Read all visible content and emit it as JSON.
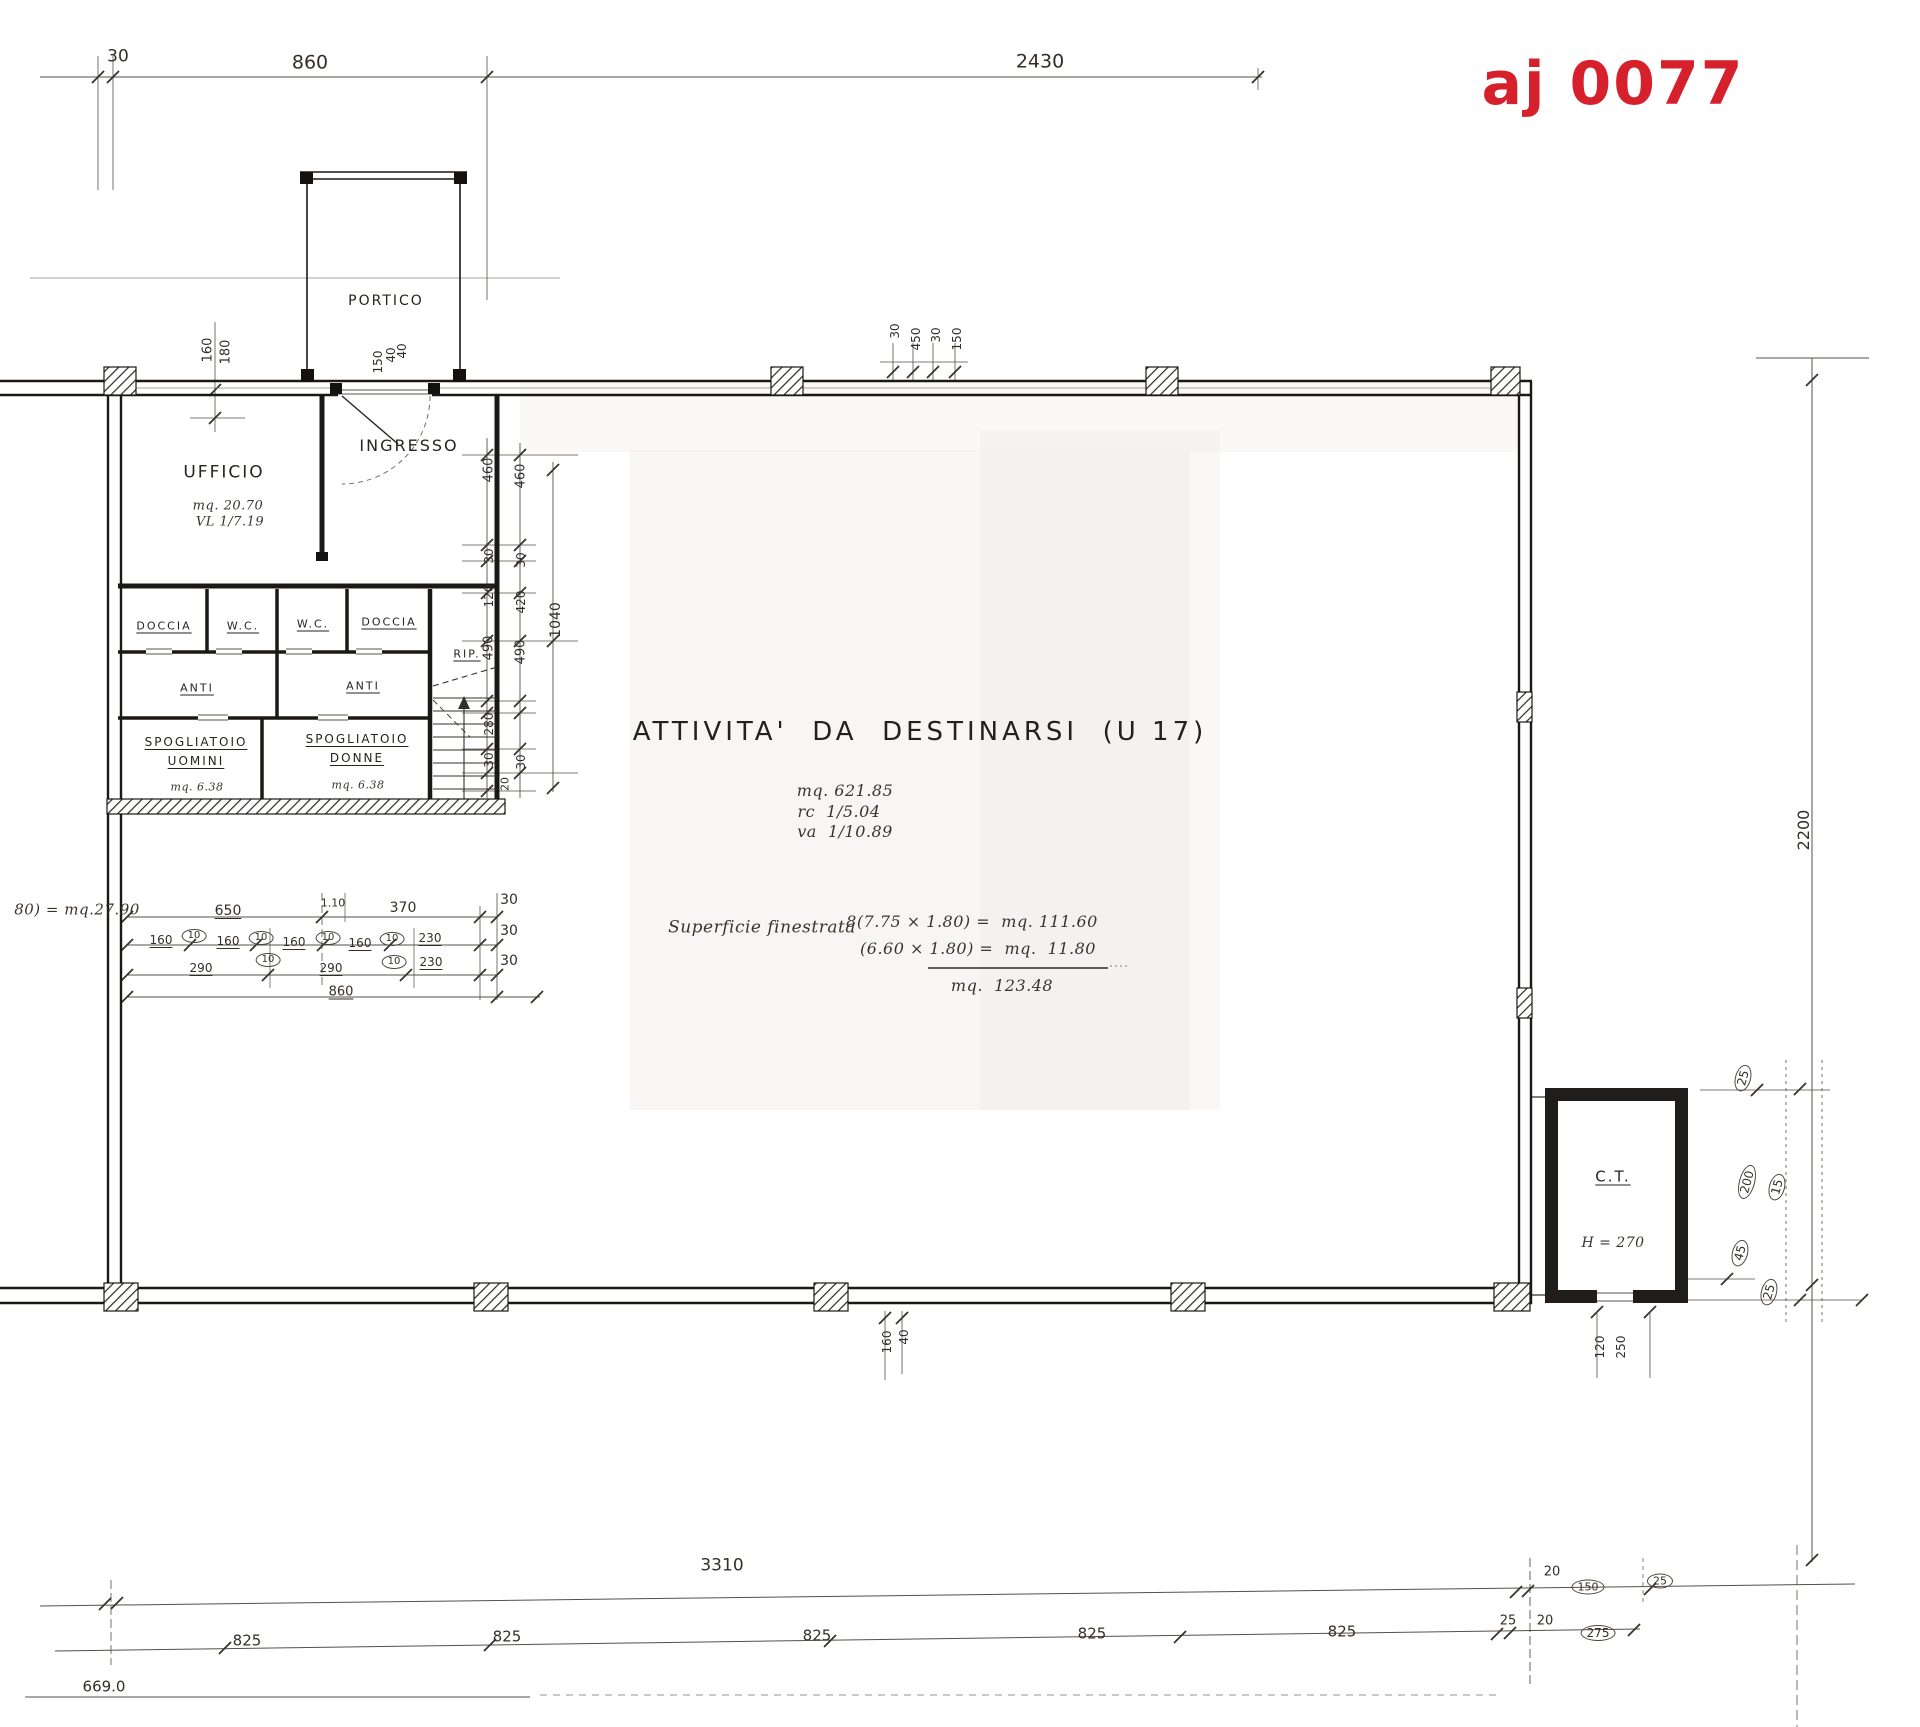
{
  "stamp": {
    "text": "aj 0077",
    "color": "#d6202b"
  },
  "labels": [
    {
      "n": "dim-top-30",
      "t": "30",
      "x": 118,
      "y": 57,
      "fs": 17
    },
    {
      "n": "dim-top-860",
      "t": "860",
      "x": 310,
      "y": 63,
      "fs": 19
    },
    {
      "n": "dim-top-2430",
      "t": "2430",
      "x": 1040,
      "y": 62,
      "fs": 19
    },
    {
      "n": "room-portico",
      "t": "PORTICO",
      "x": 386,
      "y": 301,
      "fs": 14,
      "cls": "room"
    },
    {
      "n": "dim-160",
      "t": "160",
      "x": 208,
      "y": 350,
      "r": -90,
      "fs": 13
    },
    {
      "n": "dim-180",
      "t": "180",
      "x": 226,
      "y": 352,
      "r": -90,
      "fs": 13
    },
    {
      "n": "dim-150",
      "t": "150",
      "x": 378,
      "y": 362,
      "r": -90,
      "fs": 12
    },
    {
      "n": "dim-40",
      "t": "40",
      "x": 391,
      "y": 355,
      "r": -90,
      "fs": 12
    },
    {
      "n": "dim-40",
      "t": "40",
      "x": 402,
      "y": 351,
      "r": -90,
      "fs": 12
    },
    {
      "n": "dim-30",
      "t": "30",
      "x": 895,
      "y": 331,
      "r": -90,
      "fs": 12
    },
    {
      "n": "dim-450",
      "t": "450",
      "x": 916,
      "y": 339,
      "r": -90,
      "fs": 12
    },
    {
      "n": "dim-30",
      "t": "30",
      "x": 936,
      "y": 335,
      "r": -90,
      "fs": 12
    },
    {
      "n": "dim-150",
      "t": "150",
      "x": 957,
      "y": 339,
      "r": -90,
      "fs": 12
    },
    {
      "n": "room-ingresso",
      "t": "INGRESSO",
      "x": 409,
      "y": 446,
      "fs": 16,
      "cls": "room"
    },
    {
      "n": "room-ufficio",
      "t": "UFFICIO",
      "x": 224,
      "y": 473,
      "fs": 17,
      "cls": "room"
    },
    {
      "n": "ufficio-area",
      "t": "mq. 20.70",
      "x": 228,
      "y": 506,
      "fs": 13,
      "cls": "script"
    },
    {
      "n": "ufficio-ratio",
      "t": "VL 1/7.19",
      "x": 230,
      "y": 522,
      "fs": 13,
      "cls": "script"
    },
    {
      "n": "room-doccia",
      "t": "DOCCIA",
      "x": 164,
      "y": 626,
      "fs": 11,
      "cls": "room und"
    },
    {
      "n": "room-wc",
      "t": "W.C.",
      "x": 243,
      "y": 626,
      "fs": 11,
      "cls": "room und"
    },
    {
      "n": "room-wc",
      "t": "W.C.",
      "x": 313,
      "y": 624,
      "fs": 11,
      "cls": "room und"
    },
    {
      "n": "room-doccia",
      "t": "DOCCIA",
      "x": 389,
      "y": 622,
      "fs": 11,
      "cls": "room und"
    },
    {
      "n": "room-rip",
      "t": "RIP.",
      "x": 467,
      "y": 654,
      "fs": 11,
      "cls": "room und"
    },
    {
      "n": "room-anti",
      "t": "ANTI",
      "x": 197,
      "y": 688,
      "fs": 11,
      "cls": "room und"
    },
    {
      "n": "room-anti",
      "t": "ANTI",
      "x": 363,
      "y": 686,
      "fs": 11,
      "cls": "room und"
    },
    {
      "n": "room-spogliatoio-uomini",
      "t": "SPOGLIATOIO",
      "x": 196,
      "y": 742,
      "fs": 12,
      "cls": "room und"
    },
    {
      "n": "room-spogliatoio-uomini",
      "t": "UOMINI",
      "x": 196,
      "y": 761,
      "fs": 12,
      "cls": "room und"
    },
    {
      "n": "spogliatoio-uomini-area",
      "t": "mq. 6.38",
      "x": 197,
      "y": 787,
      "fs": 11,
      "cls": "script"
    },
    {
      "n": "room-spogliatoio-donne",
      "t": "SPOGLIATOIO",
      "x": 357,
      "y": 739,
      "fs": 12,
      "cls": "room und"
    },
    {
      "n": "room-spogliatoio-donne",
      "t": "DONNE",
      "x": 357,
      "y": 758,
      "fs": 12,
      "cls": "room und"
    },
    {
      "n": "spogliatoio-donne-area",
      "t": "mq. 6.38",
      "x": 358,
      "y": 785,
      "fs": 11,
      "cls": "script"
    },
    {
      "n": "dim-460",
      "t": "460",
      "x": 489,
      "y": 470,
      "r": -90,
      "fs": 13
    },
    {
      "n": "dim-460",
      "t": "460",
      "x": 521,
      "y": 476,
      "r": -90,
      "fs": 13
    },
    {
      "n": "dim-30",
      "t": "30",
      "x": 489,
      "y": 556,
      "r": -90,
      "fs": 12
    },
    {
      "n": "dim-30",
      "t": "30",
      "x": 521,
      "y": 560,
      "r": -90,
      "fs": 12
    },
    {
      "n": "dim-120",
      "t": "120",
      "x": 489,
      "y": 596,
      "r": -90,
      "fs": 12
    },
    {
      "n": "dim-420",
      "t": "420",
      "x": 521,
      "y": 602,
      "r": -90,
      "fs": 12
    },
    {
      "n": "dim-490",
      "t": "490",
      "x": 489,
      "y": 648,
      "r": -90,
      "fs": 13
    },
    {
      "n": "dim-490",
      "t": "490",
      "x": 521,
      "y": 652,
      "r": -90,
      "fs": 13
    },
    {
      "n": "dim-1040",
      "t": "1040",
      "x": 556,
      "y": 620,
      "r": -90,
      "fs": 14
    },
    {
      "n": "dim-280",
      "t": "280",
      "x": 489,
      "y": 724,
      "r": -90,
      "fs": 12
    },
    {
      "n": "dim-30",
      "t": "30",
      "x": 489,
      "y": 760,
      "r": -90,
      "fs": 12
    },
    {
      "n": "dim-30",
      "t": "30",
      "x": 521,
      "y": 762,
      "r": -90,
      "fs": 12
    },
    {
      "n": "dim-20",
      "t": "20",
      "x": 505,
      "y": 784,
      "r": -90,
      "fs": 11
    },
    {
      "n": "activity-title",
      "t": "ATTIVITA'  DA  DESTINARSI  (U 17)",
      "x": 920,
      "y": 732,
      "fs": 26,
      "cls": "big"
    },
    {
      "n": "activity-area",
      "t": "mq. 621.85",
      "x": 845,
      "y": 791,
      "fs": 16,
      "cls": "script"
    },
    {
      "n": "activity-rc",
      "t": "rc  1/5.04",
      "x": 839,
      "y": 812,
      "fs": 16,
      "cls": "script"
    },
    {
      "n": "activity-va",
      "t": "va  1/10.89",
      "x": 845,
      "y": 832,
      "fs": 16,
      "cls": "script"
    },
    {
      "n": "window-calc-label",
      "t": "Superficie finestrata",
      "x": 762,
      "y": 928,
      "fs": 17,
      "cls": "script"
    },
    {
      "n": "window-calc-line1",
      "t": "8(7.75 × 1.80) =  mq. 111.60",
      "x": 972,
      "y": 922,
      "fs": 16,
      "cls": "script"
    },
    {
      "n": "window-calc-line2",
      "t": "(6.60 × 1.80) =  mq.  11.80",
      "x": 978,
      "y": 949,
      "fs": 16,
      "cls": "script"
    },
    {
      "n": "window-calc-total",
      "t": "mq.  123.48",
      "x": 1002,
      "y": 986,
      "fs": 16,
      "cls": "script"
    },
    {
      "n": "left-area-note",
      "t": "80) = mq.27.90",
      "x": 77,
      "y": 910,
      "fs": 15,
      "cls": "script"
    },
    {
      "n": "dim-650",
      "t": "650",
      "x": 228,
      "y": 911,
      "fs": 14,
      "cls": "und"
    },
    {
      "n": "dim-110",
      "t": "1.10",
      "x": 333,
      "y": 903,
      "fs": 11
    },
    {
      "n": "dim-370",
      "t": "370",
      "x": 403,
      "y": 908,
      "fs": 14
    },
    {
      "n": "dim-30",
      "t": "30",
      "x": 509,
      "y": 900,
      "fs": 14
    },
    {
      "n": "dim-160",
      "t": "160",
      "x": 161,
      "y": 940,
      "fs": 12,
      "cls": "und"
    },
    {
      "n": "dim-10",
      "t": "10",
      "x": 194,
      "y": 936,
      "fs": 10,
      "cls": "circ"
    },
    {
      "n": "dim-160",
      "t": "160",
      "x": 228,
      "y": 941,
      "fs": 12,
      "cls": "und"
    },
    {
      "n": "dim-10",
      "t": "10",
      "x": 261,
      "y": 938,
      "fs": 10,
      "cls": "circ"
    },
    {
      "n": "dim-160",
      "t": "160",
      "x": 294,
      "y": 942,
      "fs": 12,
      "cls": "und"
    },
    {
      "n": "dim-10",
      "t": "10",
      "x": 328,
      "y": 938,
      "fs": 10,
      "cls": "circ"
    },
    {
      "n": "dim-160",
      "t": "160",
      "x": 360,
      "y": 943,
      "fs": 12,
      "cls": "und"
    },
    {
      "n": "dim-10",
      "t": "10",
      "x": 392,
      "y": 939,
      "fs": 10,
      "cls": "circ"
    },
    {
      "n": "dim-230",
      "t": "230",
      "x": 430,
      "y": 938,
      "fs": 12,
      "cls": "und"
    },
    {
      "n": "dim-30",
      "t": "30",
      "x": 509,
      "y": 931,
      "fs": 14
    },
    {
      "n": "dim-290",
      "t": "290",
      "x": 201,
      "y": 968,
      "fs": 12,
      "cls": "und"
    },
    {
      "n": "dim-10",
      "t": "10",
      "x": 268,
      "y": 960,
      "fs": 10,
      "cls": "circ"
    },
    {
      "n": "dim-290",
      "t": "290",
      "x": 331,
      "y": 968,
      "fs": 12,
      "cls": "und"
    },
    {
      "n": "dim-10",
      "t": "10",
      "x": 394,
      "y": 962,
      "fs": 10,
      "cls": "circ"
    },
    {
      "n": "dim-230",
      "t": "230",
      "x": 431,
      "y": 962,
      "fs": 12,
      "cls": "und"
    },
    {
      "n": "dim-30",
      "t": "30",
      "x": 509,
      "y": 961,
      "fs": 14
    },
    {
      "n": "dim-860",
      "t": "860",
      "x": 341,
      "y": 992,
      "fs": 13,
      "cls": "und"
    },
    {
      "n": "dim-right-2200",
      "t": "2200",
      "x": 1804,
      "y": 830,
      "r": -90,
      "fs": 16
    },
    {
      "n": "room-ct",
      "t": "C.T.",
      "x": 1613,
      "y": 1177,
      "fs": 15,
      "cls": "room und"
    },
    {
      "n": "ct-height",
      "t": "H = 270",
      "x": 1613,
      "y": 1243,
      "fs": 14,
      "cls": "script"
    },
    {
      "n": "dim-120",
      "t": "120",
      "x": 1600,
      "y": 1347,
      "r": -90,
      "fs": 12
    },
    {
      "n": "dim-250",
      "t": "250",
      "x": 1621,
      "y": 1347,
      "r": -90,
      "fs": 12
    },
    {
      "n": "mark-25",
      "t": "25",
      "x": 1743,
      "y": 1078,
      "r": -75,
      "fs": 12,
      "cls": "circ"
    },
    {
      "n": "mark-200",
      "t": "200",
      "x": 1747,
      "y": 1182,
      "r": -75,
      "fs": 12,
      "cls": "circ"
    },
    {
      "n": "mark-15",
      "t": "15",
      "x": 1777,
      "y": 1187,
      "r": -75,
      "fs": 12,
      "cls": "circ"
    },
    {
      "n": "mark-45",
      "t": "45",
      "x": 1740,
      "y": 1253,
      "r": -75,
      "fs": 12,
      "cls": "circ"
    },
    {
      "n": "mark-25",
      "t": "25",
      "x": 1769,
      "y": 1292,
      "r": -75,
      "fs": 12,
      "cls": "circ"
    },
    {
      "n": "dim-160",
      "t": "160",
      "x": 887,
      "y": 1342,
      "r": -90,
      "fs": 12
    },
    {
      "n": "dim-40",
      "t": "40",
      "x": 904,
      "y": 1337,
      "r": -90,
      "fs": 12
    },
    {
      "n": "dim-bottom-3310",
      "t": "3310",
      "x": 722,
      "y": 1566,
      "fs": 17
    },
    {
      "n": "dim-20",
      "t": "20",
      "x": 1552,
      "y": 1572,
      "fs": 13
    },
    {
      "n": "mark-150",
      "t": "150",
      "x": 1588,
      "y": 1587,
      "fs": 11,
      "cls": "circ"
    },
    {
      "n": "mark-25",
      "t": "25",
      "x": 1660,
      "y": 1581,
      "fs": 11,
      "cls": "circ"
    },
    {
      "n": "dim-825",
      "t": "825",
      "x": 247,
      "y": 1641,
      "fs": 15
    },
    {
      "n": "dim-825",
      "t": "825",
      "x": 507,
      "y": 1637,
      "fs": 15
    },
    {
      "n": "dim-825",
      "t": "825",
      "x": 817,
      "y": 1636,
      "fs": 15
    },
    {
      "n": "dim-825",
      "t": "825",
      "x": 1092,
      "y": 1634,
      "fs": 15
    },
    {
      "n": "dim-825",
      "t": "825",
      "x": 1342,
      "y": 1632,
      "fs": 15
    },
    {
      "n": "dim-25",
      "t": "25",
      "x": 1508,
      "y": 1621,
      "fs": 13
    },
    {
      "n": "dim-20",
      "t": "20",
      "x": 1545,
      "y": 1621,
      "fs": 13
    },
    {
      "n": "mark-275",
      "t": "275",
      "x": 1598,
      "y": 1633,
      "fs": 12,
      "cls": "circ"
    },
    {
      "n": "dim-6690",
      "t": "669.0",
      "x": 104,
      "y": 1687,
      "fs": 15
    }
  ]
}
